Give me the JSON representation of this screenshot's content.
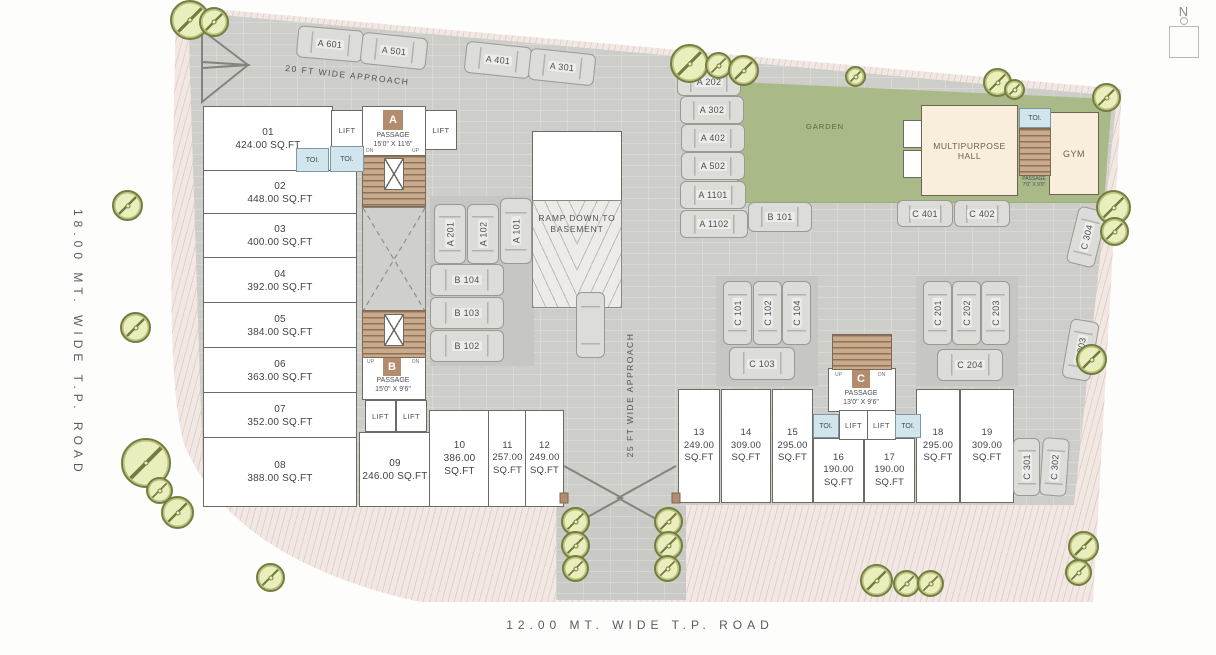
{
  "north": "N",
  "roads": {
    "left": "18.00 MT. WIDE T.P. ROAD",
    "bottom": "12.00 MT. WIDE T.P. ROAD",
    "approach_top": "20 FT WIDE APPROACH",
    "approach_side": "25 FT WIDE APPROACH"
  },
  "labels": {
    "garden": "GARDEN",
    "hall": "MULTIPURPOSE HALL",
    "gym": "GYM",
    "ramp": "RAMP DOWN TO BASEMENT"
  },
  "misc": {
    "lift": "LIFT",
    "toi": "TOI.",
    "up": "UP",
    "dn": "DN"
  },
  "stairs": {
    "a": {
      "letter": "A",
      "line1": "PASSAGE",
      "line2": "15'0\" X 11'6\""
    },
    "b": {
      "letter": "B",
      "line1": "PASSAGE",
      "line2": "15'0\" X 9'6\""
    },
    "c": {
      "letter": "C",
      "line1": "PASSAGE",
      "line2": "13'0\" X 9'6\""
    },
    "hall": {
      "line1": "PASSAGE",
      "line2": "7'0\" X 9'0\""
    }
  },
  "shops": {
    "s01": {
      "no": "01",
      "area": "424.00 SQ.FT"
    },
    "s02": {
      "no": "02",
      "area": "448.00 SQ.FT"
    },
    "s03": {
      "no": "03",
      "area": "400.00 SQ.FT"
    },
    "s04": {
      "no": "04",
      "area": "392.00 SQ.FT"
    },
    "s05": {
      "no": "05",
      "area": "384.00 SQ.FT"
    },
    "s06": {
      "no": "06",
      "area": "363.00 SQ.FT"
    },
    "s07": {
      "no": "07",
      "area": "352.00 SQ.FT"
    },
    "s08": {
      "no": "08",
      "area": "388.00 SQ.FT"
    },
    "s09": {
      "no": "09",
      "area": "246.00 SQ.FT"
    },
    "s10": {
      "no": "10",
      "area": "386.00 SQ.FT"
    },
    "s11": {
      "no": "11",
      "area": "257.00 SQ.FT"
    },
    "s12": {
      "no": "12",
      "area": "249.00 SQ.FT"
    },
    "s13": {
      "no": "13",
      "area": "249.00 SQ.FT"
    },
    "s14": {
      "no": "14",
      "area": "309.00 SQ.FT"
    },
    "s15": {
      "no": "15",
      "area": "295.00 SQ.FT"
    },
    "s16": {
      "no": "16",
      "area": "190.00 SQ.FT"
    },
    "s17": {
      "no": "17",
      "area": "190.00 SQ.FT"
    },
    "s18": {
      "no": "18",
      "area": "295.00 SQ.FT"
    },
    "s19": {
      "no": "19",
      "area": "309.00 SQ.FT"
    }
  },
  "parking": {
    "a601": "A 601",
    "a501": "A 501",
    "a401": "A 401",
    "a301": "A 301",
    "a202": "A 202",
    "a302": "A 302",
    "a402": "A 402",
    "a502": "A 502",
    "a1101": "A 1101",
    "a1102": "A 1102",
    "b101": "B 101",
    "a201": "A 201",
    "a102": "A 102",
    "a101": "A 101",
    "b104": "B 104",
    "b103": "B 103",
    "b102": "B 102",
    "c401": "C 401",
    "c402": "C 402",
    "c101": "C 101",
    "c102": "C 102",
    "c104": "C 104",
    "c103": "C 103",
    "c201": "C 201",
    "c202": "C 202",
    "c203": "C 203",
    "c204": "C 204",
    "c304": "C 304",
    "c303": "C 303",
    "c301": "C 301",
    "c302": "C 302"
  },
  "colors": {
    "plot": "#cdcdc9",
    "sidewalk": "#f2e8e3",
    "garden": "#a9ba88",
    "amenity": "#f8eedb",
    "toi_blue": "#d2e5ec",
    "stair_brown": "#b28c6d",
    "tree_fill": "#eaedbc",
    "tree_line": "#747d41",
    "unit": "#ffffff",
    "road_text": "#585c61"
  }
}
